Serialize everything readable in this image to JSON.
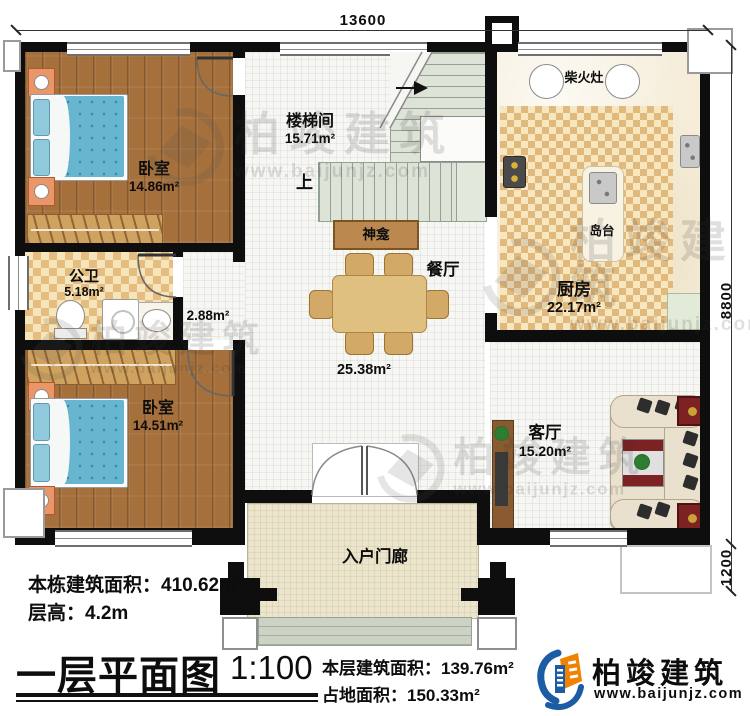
{
  "dimensions": {
    "top_width": "13600",
    "right_height": "8800",
    "porch_depth": "1200"
  },
  "rooms": {
    "bedroom_top": {
      "name": "卧室",
      "area": "14.86m²"
    },
    "stairwell": {
      "name": "楼梯间",
      "area": "15.71m²",
      "up_label": "上"
    },
    "kitchen": {
      "name": "厨房",
      "area": "22.17m²",
      "wood_stove_label": "柴火灶",
      "island_label": "岛台"
    },
    "bathroom": {
      "name": "公卫",
      "area": "5.18m²"
    },
    "hallway": {
      "area": "2.88m²"
    },
    "bedroom_bottom": {
      "name": "卧室",
      "area": "14.51m²"
    },
    "dining": {
      "name": "餐厅",
      "area": "25.38m²",
      "shrine_label": "神龛"
    },
    "living": {
      "name": "客厅",
      "area": "15.20m²"
    },
    "porch": {
      "name": "入户门廊"
    }
  },
  "title_block": {
    "total_building_area": "本栋建筑面积：410.62m²",
    "floor_height": "层高：4.2m",
    "plan_title": "一层平面图",
    "scale": "1:100",
    "floor_area": "本层建筑面积：139.76m²",
    "footprint_area": "占地面积：150.33m²"
  },
  "branding": {
    "company": "柏竣建筑",
    "website": "www.baijunjz.com"
  },
  "watermark": {
    "company": "柏竣建筑",
    "website": "www.baijunjz.com"
  },
  "colors": {
    "wall": "#0e0e0e",
    "brand_blue": "#1b5ca5",
    "brand_orange": "#ef8200"
  }
}
